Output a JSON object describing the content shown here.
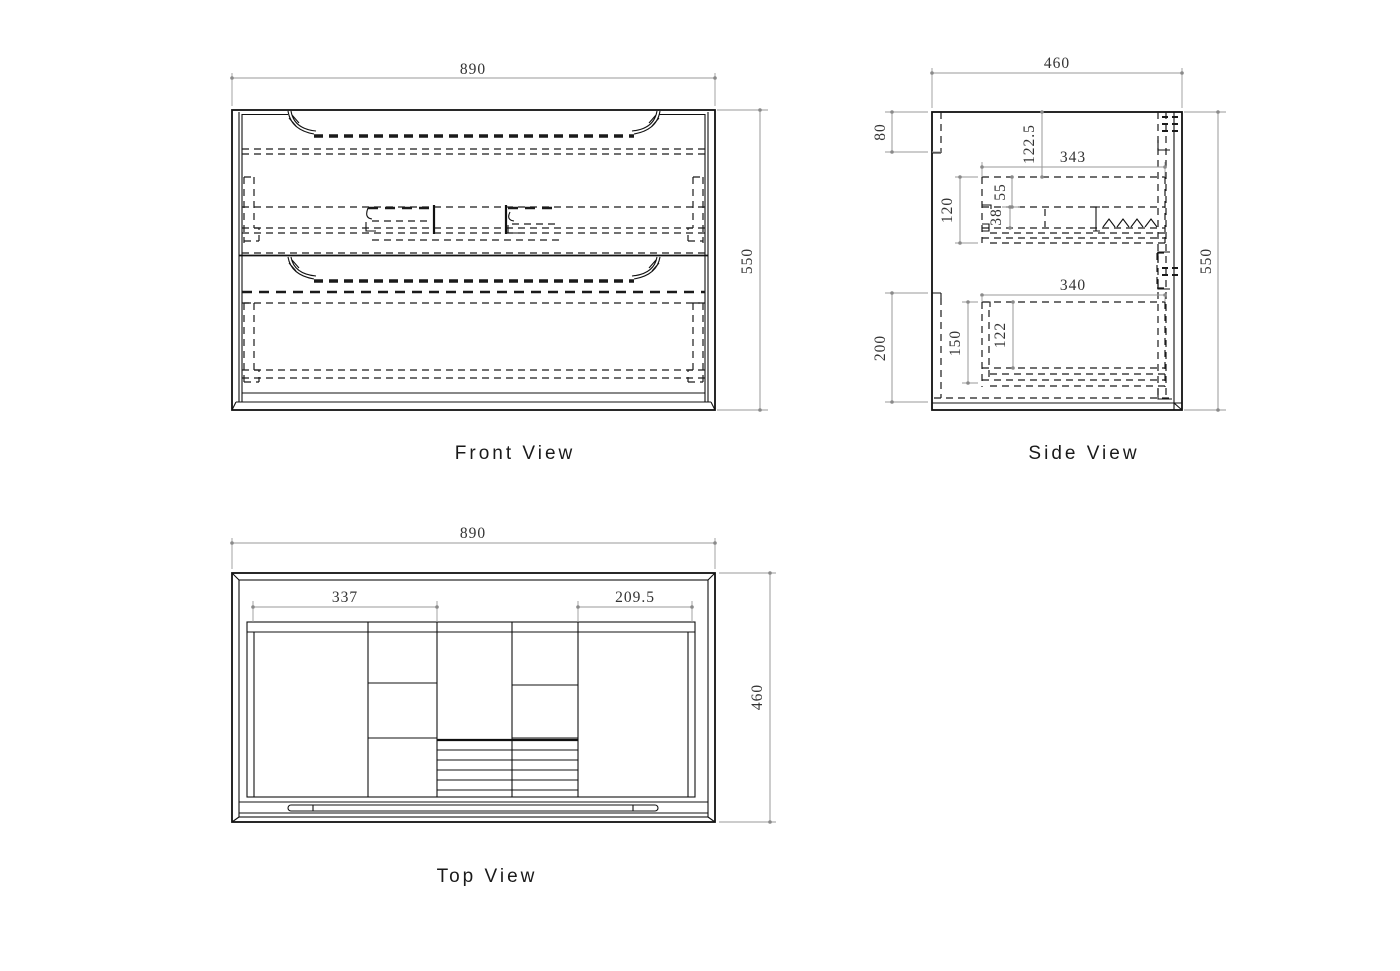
{
  "drawing": {
    "front_view": {
      "label": "Front View",
      "dims": {
        "width": "890",
        "height": "550"
      }
    },
    "side_view": {
      "label": "Side View",
      "dims": {
        "width": "460",
        "height": "550",
        "d80": "80",
        "d122_5": "122.5",
        "d343": "343",
        "d120": "120",
        "d55": "55",
        "d38": "38",
        "d200": "200",
        "d150": "150",
        "d122": "122",
        "d340": "340"
      }
    },
    "top_view": {
      "label": "Top View",
      "dims": {
        "width": "890",
        "depth": "460",
        "d337": "337",
        "d209_5": "209.5"
      }
    }
  },
  "colors": {
    "background": "#ffffff",
    "line": "#111111",
    "hidden_line": "#1a1a1a",
    "dimension_line": "#9a9a9a",
    "dimension_text": "#333333",
    "label_text": "#1a1a1a"
  }
}
